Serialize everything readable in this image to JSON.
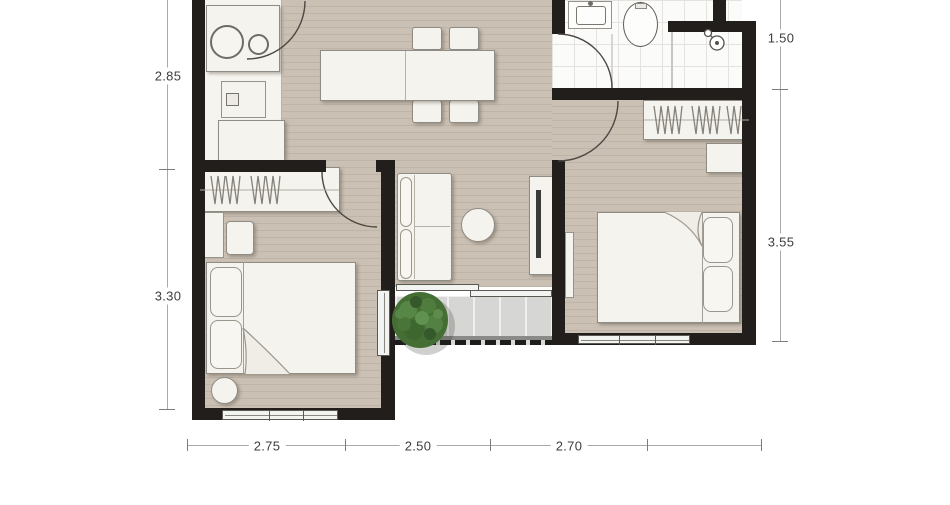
{
  "plan": {
    "type": "apartment-floor-plan",
    "dimensions": {
      "left": [
        "2.85",
        "3.30"
      ],
      "right": [
        "1.50",
        "3.55"
      ],
      "bottom": [
        "2.75",
        "2.50",
        "2.70"
      ]
    },
    "colors": {
      "wall": "#221e1b",
      "wood_floor": "#cac0b4",
      "wood_stripe": "#beb4a8",
      "fixture_white": "#f5f3ee",
      "bath_tile": "#fbfbfa",
      "balcony_tile": "#d6d6d4",
      "plant_green": "#456e35",
      "dimension_text": "#3d3d3d"
    }
  }
}
